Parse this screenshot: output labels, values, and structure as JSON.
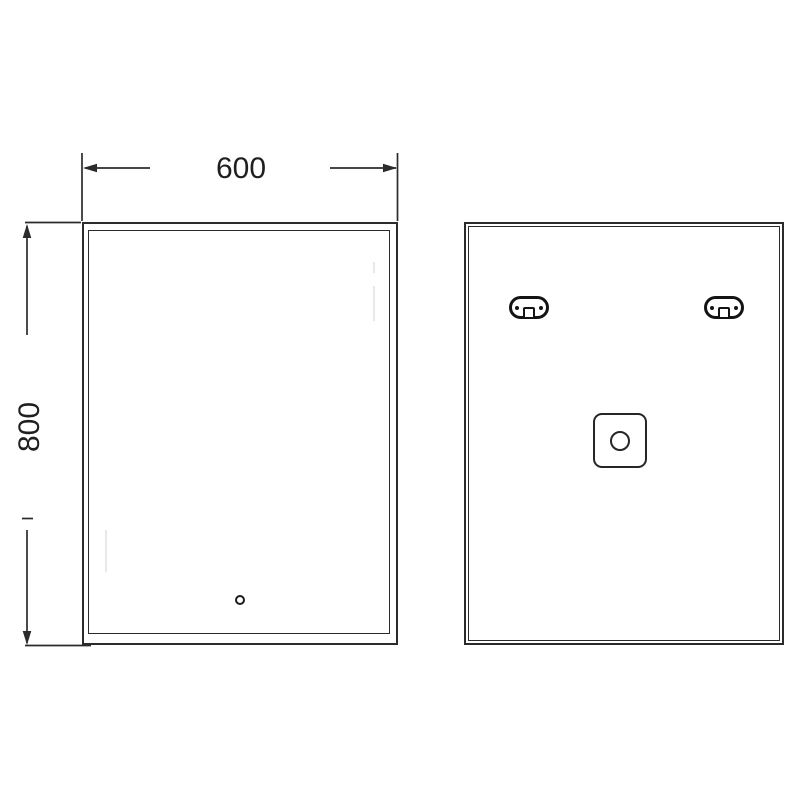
{
  "drawing": {
    "type": "technical-drawing",
    "subject": "bathroom mirror front and back elevation views",
    "dimensions": {
      "width": {
        "label": "600"
      },
      "height": {
        "label": "800"
      }
    },
    "front_view": {
      "name": "front-view",
      "features": [
        "outer-frame",
        "inner-frame",
        "touch-sensor"
      ]
    },
    "back_view": {
      "name": "back-view",
      "features": [
        "mounting-bracket-left",
        "mounting-bracket-right",
        "junction-box"
      ]
    },
    "colors": {
      "line": "#2b2b2b",
      "bracket_line": "#141414",
      "faint_reflection": "#e8e8e8",
      "background": "#ffffff"
    }
  }
}
